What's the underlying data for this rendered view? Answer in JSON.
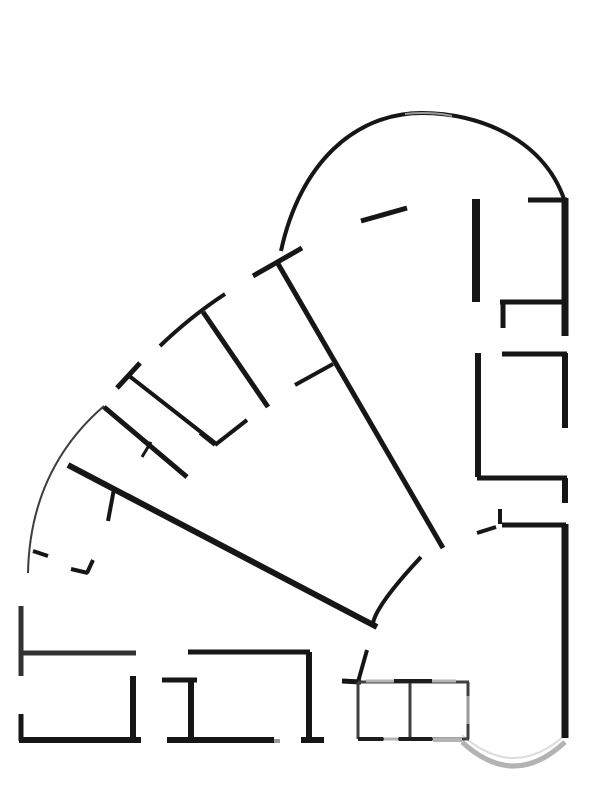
{
  "page": {
    "width": 613,
    "height": 805,
    "background": "#ffffff"
  },
  "drawing": {
    "name": "architectural-floor-plan",
    "colors": {
      "wall_black": "#161616",
      "wall_dark": "#333333",
      "core_dark": "#3f3f3f",
      "accent_black": "#1d1d1d",
      "glass_gray": "#b3b3b3",
      "glass_mid": "#9a9a9a",
      "glass_light": "#dcdcdc",
      "arc_thin": "#3c3c3c"
    },
    "paths": [
      {
        "name": "big-top-arc",
        "d": "M 281,251 C 300,163 355,113 422,113 C 479,113 543,139 564,199",
        "stroke": "wall_black",
        "width": 4
      },
      {
        "name": "big-top-arc-glint",
        "d": "M 405,114 C 420,112 440,113 452,116",
        "stroke": "glass_mid",
        "width": 2
      },
      {
        "name": "left-thin-arc",
        "d": "M 104,406 Q 30,470 28,573",
        "stroke": "arc_thin",
        "width": 2
      },
      {
        "name": "inner-center-arc",
        "d": "M 421,557 Q 377,604 373,623",
        "stroke": "wall_black",
        "width": 4
      },
      {
        "name": "bay-window-arc-outer",
        "d": "M 462,742 Q 514,790 565,742",
        "stroke": "glass_gray",
        "width": 5
      },
      {
        "name": "bay-window-arc-inner",
        "d": "M 462,735 Q 514,781 565,735",
        "stroke": "glass_light",
        "width": 2
      },
      {
        "name": "radial-b-crossbar",
        "d": "M 160,346 Q 190,317 225,294",
        "stroke": "wall_black",
        "width": 4
      }
    ],
    "segments": [
      {
        "name": "radial-a-stem",
        "x1": 277,
        "y1": 262,
        "x2": 443,
        "y2": 548,
        "stroke": "wall_black",
        "width": 5
      },
      {
        "name": "radial-a-crossbar",
        "x1": 253,
        "y1": 276,
        "x2": 302,
        "y2": 248,
        "stroke": "wall_black",
        "width": 5
      },
      {
        "name": "radial-a-tick",
        "x1": 333,
        "y1": 364,
        "x2": 295,
        "y2": 385,
        "stroke": "wall_black",
        "width": 4
      },
      {
        "name": "radial-b-stem",
        "x1": 203,
        "y1": 312,
        "x2": 268,
        "y2": 407,
        "stroke": "wall_black",
        "width": 5
      },
      {
        "name": "radial-b-end-wall",
        "x1": 247,
        "y1": 420,
        "x2": 215,
        "y2": 445,
        "stroke": "wall_black",
        "width": 4
      },
      {
        "name": "radial-b-end-jamb",
        "x1": 215,
        "y1": 445,
        "x2": 200,
        "y2": 433,
        "stroke": "wall_black",
        "width": 4
      },
      {
        "name": "radial-c-stem",
        "x1": 104,
        "y1": 407,
        "x2": 187,
        "y2": 477,
        "stroke": "wall_black",
        "width": 5
      },
      {
        "name": "radial-c-tick",
        "x1": 151,
        "y1": 442,
        "x2": 142,
        "y2": 457,
        "stroke": "wall_black",
        "width": 3
      },
      {
        "name": "radial-d-stem",
        "x1": 128,
        "y1": 375,
        "x2": 215,
        "y2": 443,
        "stroke": "wall_black",
        "width": 4
      },
      {
        "name": "radial-d-crossbar",
        "x1": 117,
        "y1": 388,
        "x2": 140,
        "y2": 363,
        "stroke": "wall_black",
        "width": 5
      },
      {
        "name": "radial-e-long-wall",
        "x1": 68,
        "y1": 465,
        "x2": 377,
        "y2": 627,
        "stroke": "wall_black",
        "width": 6
      },
      {
        "name": "radial-e-tick",
        "x1": 114,
        "y1": 489,
        "x2": 108,
        "y2": 521,
        "stroke": "wall_black",
        "width": 4
      },
      {
        "name": "arc-foot-tick",
        "x1": 33,
        "y1": 551,
        "x2": 48,
        "y2": 556,
        "stroke": "wall_black",
        "width": 4
      },
      {
        "name": "arc-foot-jamb-a",
        "x1": 71,
        "y1": 569,
        "x2": 88,
        "y2": 573,
        "stroke": "wall_black",
        "width": 4
      },
      {
        "name": "arc-foot-jamb-b",
        "x1": 87,
        "y1": 573,
        "x2": 93,
        "y2": 560,
        "stroke": "wall_black",
        "width": 4
      },
      {
        "name": "top-slant-stub",
        "x1": 361,
        "y1": 221,
        "x2": 407,
        "y2": 208,
        "stroke": "wall_black",
        "width": 5
      },
      {
        "name": "rt-room-top-wall",
        "x1": 528,
        "y1": 200,
        "x2": 567,
        "y2": 200,
        "stroke": "wall_black",
        "width": 5
      },
      {
        "name": "rt-outer-wall-upper",
        "x1": 565,
        "y1": 198,
        "x2": 565,
        "y2": 336,
        "stroke": "wall_black",
        "width": 7
      },
      {
        "name": "rt-pier-wall",
        "x1": 476,
        "y1": 199,
        "x2": 476,
        "y2": 302,
        "stroke": "wall_black",
        "width": 8
      },
      {
        "name": "rt-room-divider-1",
        "x1": 500,
        "y1": 302,
        "x2": 567,
        "y2": 302,
        "stroke": "wall_black",
        "width": 5
      },
      {
        "name": "rt-room-divider-1-jamb",
        "x1": 503,
        "y1": 302,
        "x2": 503,
        "y2": 328,
        "stroke": "wall_black",
        "width": 5
      },
      {
        "name": "rt-room-divider-2",
        "x1": 502,
        "y1": 354,
        "x2": 567,
        "y2": 354,
        "stroke": "wall_black",
        "width": 5
      },
      {
        "name": "rt-outer-wall-mid",
        "x1": 565,
        "y1": 353,
        "x2": 565,
        "y2": 428,
        "stroke": "wall_black",
        "width": 6
      },
      {
        "name": "rt-inner-wall-long",
        "x1": 478,
        "y1": 353,
        "x2": 478,
        "y2": 477,
        "stroke": "wall_black",
        "width": 6
      },
      {
        "name": "rt-room-divider-3",
        "x1": 477,
        "y1": 478,
        "x2": 567,
        "y2": 478,
        "stroke": "wall_black",
        "width": 5
      },
      {
        "name": "rt-outer-wall-stub",
        "x1": 565,
        "y1": 478,
        "x2": 565,
        "y2": 503,
        "stroke": "wall_black",
        "width": 6
      },
      {
        "name": "rt-door-jamb-v",
        "x1": 500,
        "y1": 509,
        "x2": 500,
        "y2": 524,
        "stroke": "wall_black",
        "width": 4
      },
      {
        "name": "rt-room-divider-4",
        "x1": 502,
        "y1": 525,
        "x2": 566,
        "y2": 525,
        "stroke": "wall_black",
        "width": 5
      },
      {
        "name": "rt-door-diagonal",
        "x1": 477,
        "y1": 533,
        "x2": 496,
        "y2": 527,
        "stroke": "wall_black",
        "width": 4
      },
      {
        "name": "rt-outer-wall-lower",
        "x1": 565,
        "y1": 524,
        "x2": 565,
        "y2": 738,
        "stroke": "wall_black",
        "width": 7
      },
      {
        "name": "bl-left-wall-upper",
        "x1": 21,
        "y1": 606,
        "x2": 21,
        "y2": 676,
        "stroke": "wall_dark",
        "width": 5
      },
      {
        "name": "bl-top-wall",
        "x1": 19,
        "y1": 653,
        "x2": 136,
        "y2": 653,
        "stroke": "wall_dark",
        "width": 5
      },
      {
        "name": "bl-right-wall",
        "x1": 133,
        "y1": 676,
        "x2": 133,
        "y2": 741,
        "stroke": "wall_black",
        "width": 6
      },
      {
        "name": "bl-left-wall-lower",
        "x1": 21,
        "y1": 714,
        "x2": 21,
        "y2": 741,
        "stroke": "wall_black",
        "width": 5
      },
      {
        "name": "bl-bottom-wall",
        "x1": 19,
        "y1": 740,
        "x2": 141,
        "y2": 740,
        "stroke": "wall_black",
        "width": 6
      },
      {
        "name": "bm-top-wall",
        "x1": 188,
        "y1": 652,
        "x2": 310,
        "y2": 652,
        "stroke": "wall_black",
        "width": 5
      },
      {
        "name": "bm-right-wall",
        "x1": 309,
        "y1": 652,
        "x2": 309,
        "y2": 740,
        "stroke": "wall_black",
        "width": 6
      },
      {
        "name": "bm-right-wall-foot",
        "x1": 301,
        "y1": 740,
        "x2": 324,
        "y2": 740,
        "stroke": "wall_black",
        "width": 6
      },
      {
        "name": "bm-closet-top",
        "x1": 162,
        "y1": 680,
        "x2": 197,
        "y2": 680,
        "stroke": "wall_black",
        "width": 5
      },
      {
        "name": "bm-closet-wall",
        "x1": 191,
        "y1": 679,
        "x2": 191,
        "y2": 741,
        "stroke": "wall_black",
        "width": 6
      },
      {
        "name": "bm-bottom-wall",
        "x1": 167,
        "y1": 740,
        "x2": 274,
        "y2": 740,
        "stroke": "wall_black",
        "width": 6
      },
      {
        "name": "bm-bottom-wall-gray",
        "x1": 274,
        "y1": 741,
        "x2": 280,
        "y2": 741,
        "stroke": "glass_mid",
        "width": 4
      },
      {
        "name": "core-entry-stub-v",
        "x1": 367,
        "y1": 650,
        "x2": 358,
        "y2": 682,
        "stroke": "wall_black",
        "width": 4
      },
      {
        "name": "core-entry-stub-h",
        "x1": 342,
        "y1": 681,
        "x2": 361,
        "y2": 682,
        "stroke": "wall_black",
        "width": 5
      },
      {
        "name": "core-top-edge",
        "x1": 358,
        "y1": 682,
        "x2": 469,
        "y2": 682,
        "stroke": "core_dark",
        "width": 3
      },
      {
        "name": "core-bottom-edge",
        "x1": 358,
        "y1": 739,
        "x2": 469,
        "y2": 739,
        "stroke": "core_dark",
        "width": 3
      },
      {
        "name": "core-left-edge",
        "x1": 358,
        "y1": 682,
        "x2": 358,
        "y2": 739,
        "stroke": "core_dark",
        "width": 3
      },
      {
        "name": "core-right-edge",
        "x1": 468,
        "y1": 682,
        "x2": 468,
        "y2": 739,
        "stroke": "core_dark",
        "width": 3
      },
      {
        "name": "core-divider",
        "x1": 410,
        "y1": 682,
        "x2": 410,
        "y2": 739,
        "stroke": "core_dark",
        "width": 3
      },
      {
        "name": "core-top-glass-a",
        "x1": 366,
        "y1": 681,
        "x2": 394,
        "y2": 681,
        "stroke": "glass_gray",
        "width": 3
      },
      {
        "name": "core-top-glass-b",
        "x1": 432,
        "y1": 681,
        "x2": 456,
        "y2": 681,
        "stroke": "glass_gray",
        "width": 3
      },
      {
        "name": "core-top-accent",
        "x1": 394,
        "y1": 681,
        "x2": 432,
        "y2": 681,
        "stroke": "accent_black",
        "width": 4
      },
      {
        "name": "core-bottom-accent-a",
        "x1": 358,
        "y1": 739,
        "x2": 383,
        "y2": 739,
        "stroke": "accent_black",
        "width": 4
      },
      {
        "name": "core-bottom-accent-b",
        "x1": 399,
        "y1": 739,
        "x2": 432,
        "y2": 739,
        "stroke": "accent_black",
        "width": 4
      },
      {
        "name": "core-bottom-glass-a",
        "x1": 384,
        "y1": 739,
        "x2": 398,
        "y2": 739,
        "stroke": "glass_gray",
        "width": 3
      },
      {
        "name": "core-bottom-glass-b",
        "x1": 433,
        "y1": 740,
        "x2": 462,
        "y2": 740,
        "stroke": "glass_gray",
        "width": 4
      },
      {
        "name": "core-right-glass",
        "x1": 468,
        "y1": 696,
        "x2": 468,
        "y2": 724,
        "stroke": "glass_mid",
        "width": 3
      }
    ]
  }
}
